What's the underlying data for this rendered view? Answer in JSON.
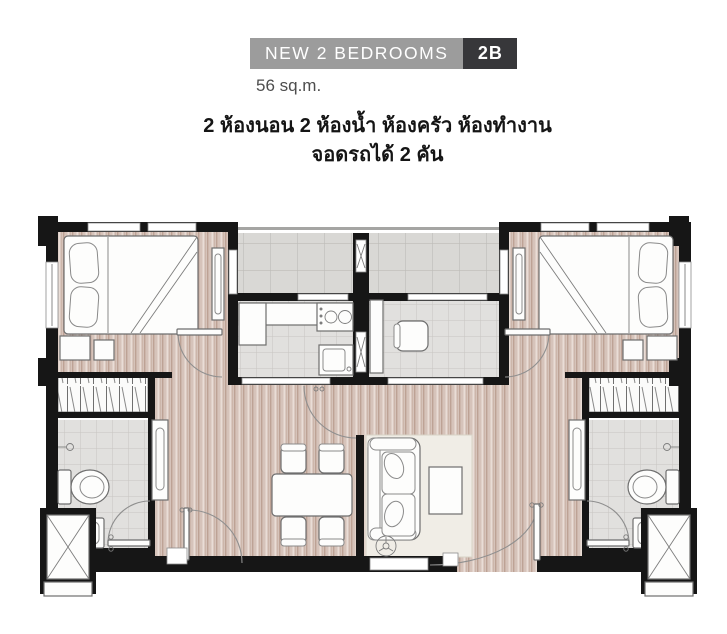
{
  "header": {
    "banner": {
      "title": "NEW 2 BEDROOMS",
      "badge": "2B"
    },
    "area": "56 sq.m.",
    "description_line1": "2 ห้องนอน 2 ห้องน้ำ ห้องครัว ห้องทำงาน",
    "description_line2": "จอดรถได้ 2 คัน"
  },
  "colors": {
    "banner_bg": "#9c9c9c",
    "badge_bg": "#37373a",
    "banner_text": "#ffffff",
    "wall": "#161616",
    "wood_floor": "#d6c3ba",
    "tile_floor": "#e1e0de",
    "balcony_tile": "#d9d8d5",
    "rug": "#f0ede6"
  },
  "floor_plan": {
    "type": "2-bedroom unit plan",
    "rooms": [
      "bedroom-left",
      "bedroom-right",
      "bathroom-left",
      "bathroom-right",
      "kitchen",
      "workroom",
      "balcony",
      "living-dining",
      "wardrobe-left",
      "wardrobe-right",
      "entrance"
    ]
  }
}
